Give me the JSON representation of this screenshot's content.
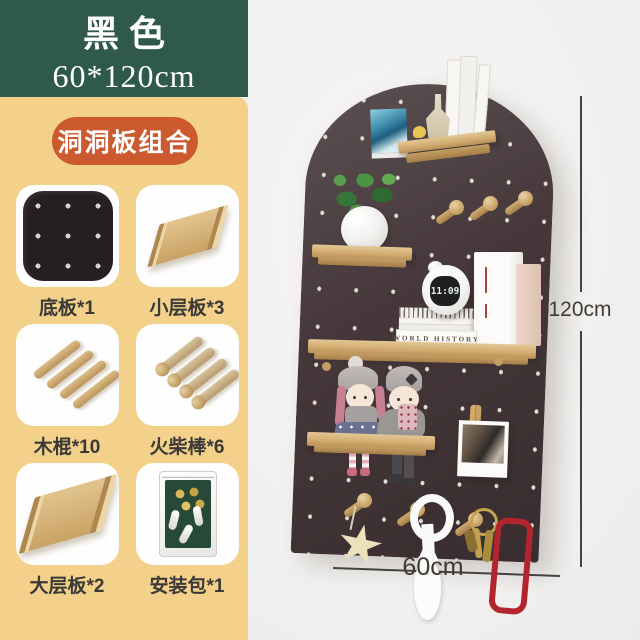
{
  "product": {
    "color_name": "黑色",
    "size": "60*120cm",
    "badge": "洞洞板组合",
    "components": [
      {
        "label": "底板*1",
        "icon": "pegboard-icon"
      },
      {
        "label": "小层板*3",
        "icon": "small-shelf-icon"
      },
      {
        "label": "木棍*10",
        "icon": "wood-sticks-icon"
      },
      {
        "label": "火柴棒*6",
        "icon": "match-pegs-icon"
      },
      {
        "label": "大层板*2",
        "icon": "large-shelf-icon"
      },
      {
        "label": "安装包*1",
        "icon": "hardware-bag-icon"
      }
    ]
  },
  "photo": {
    "height_label": "120cm",
    "width_label": "60cm",
    "clock_time": "11:09",
    "book_spine": "WORLD HISTORY"
  },
  "colors": {
    "green": "#2f5a49",
    "yellow": "#f3d18a",
    "badge": "#cd5a2e",
    "board": "#46383a",
    "wood": "#d3ae72",
    "wall": "#f1f0ee"
  }
}
